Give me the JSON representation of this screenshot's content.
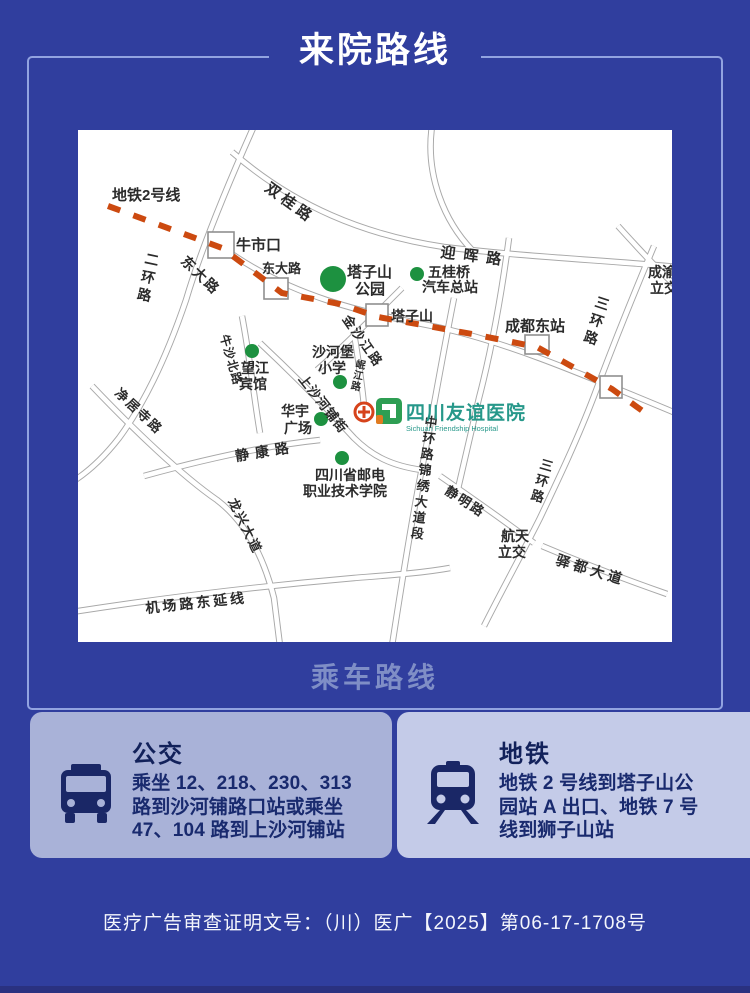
{
  "page": {
    "title": "来院路线",
    "section_label": "乘车路线",
    "footer": "医疗广告审查证明文号：（川）医广【2025】第06-17-1708号"
  },
  "cards": {
    "bus": {
      "title": "公交",
      "lines": [
        "乘坐 12、218、230、313",
        "路到沙河铺路口站或乘坐",
        "47、104 路到上沙河铺站"
      ]
    },
    "metro": {
      "title": "地铁",
      "lines": [
        "地铁 2 号线到塔子山公",
        "园站 A 出口、地铁 7 号",
        "线到狮子山站"
      ]
    }
  },
  "map": {
    "hospital": {
      "name": "四川友谊医院",
      "name_en": "Sichuan Friendship Hospital"
    },
    "metro_line": {
      "label": "地铁2号线",
      "points": [
        [
          30,
          76
        ],
        [
          144,
          118
        ],
        [
          204,
          163
        ],
        [
          262,
          174
        ],
        [
          300,
          187
        ],
        [
          394,
          204
        ],
        [
          459,
          217
        ],
        [
          534,
          259
        ],
        [
          566,
          282
        ]
      ]
    },
    "roads": [
      {
        "name": "erhuan-lu",
        "d": "M 176,-4 C 142,72 121,126 108,170 C 91,220 69,270 41,308 C 23,331 7,344 -6,352"
      },
      {
        "name": "dongda-lu-corridor",
        "d": "M 148,120 C 214,167 284,182 354,196 C 424,210 504,244 600,284"
      },
      {
        "name": "shuanggui-yinghui-lu",
        "d": "M 154,22 C 216,76 286,105 366,117 C 449,127 524,130 600,137"
      },
      {
        "name": "north-road",
        "d": "M 354,-4 C 347,46 367,92 394,120"
      },
      {
        "name": "east-station-road",
        "d": "M 431,108 C 423,168 413,222 401,268 C 393,303 386,333 379,363"
      },
      {
        "name": "sanhuan-lu",
        "d": "M 576,116 C 554,168 534,218 516,266 C 500,308 481,348 462,388 C 444,424 424,460 406,496"
      },
      {
        "name": "zhonghuan-lu",
        "d": "M 376,168 C 364,228 354,288 344,338 C 336,378 326,438 314,516"
      },
      {
        "name": "jinshajiang-lu",
        "d": "M 324,158 C 294,188 264,218 239,240"
      },
      {
        "name": "shangshahepu-jie",
        "d": "M 182,213 C 214,243 244,273 276,308 C 294,326 314,336 344,340"
      },
      {
        "name": "minjiang-lu",
        "d": "M 276,203 C 280,228 284,253 286,276"
      },
      {
        "name": "niusha-bei-lu",
        "d": "M 164,186 C 172,228 176,268 182,303"
      },
      {
        "name": "jingkang-lu",
        "d": "M 66,346 C 124,330 184,316 242,310"
      },
      {
        "name": "jingjusi-longxing",
        "d": "M 14,256 C 54,298 104,346 139,370 C 169,393 186,428 196,468 L 202,516"
      },
      {
        "name": "jichang-lu-east",
        "d": "M -6,482 C 84,468 184,456 276,448 C 314,445 344,443 372,438"
      },
      {
        "name": "jingming-lu",
        "d": "M 362,346 C 394,368 429,393 456,413"
      },
      {
        "name": "yidu-dadao",
        "d": "M 464,416 C 504,433 549,450 589,464"
      },
      {
        "name": "chengyu-crossing",
        "d": "M 540,96 C 560,118 580,140 600,158"
      }
    ],
    "stations": [
      {
        "name": "牛市口",
        "x": 130,
        "y": 102,
        "w": 26,
        "h": 26
      },
      {
        "name": "东大路",
        "x": 186,
        "y": 148,
        "w": 24,
        "h": 21
      },
      {
        "name": "塔子山",
        "x": 288,
        "y": 174,
        "w": 22,
        "h": 22
      },
      {
        "name": "成都东站",
        "x": 447,
        "y": 205,
        "w": 24,
        "h": 19
      },
      {
        "name": "station",
        "x": 522,
        "y": 246,
        "w": 22,
        "h": 22
      }
    ],
    "pois": [
      {
        "name": "塔子山公园",
        "x": 255,
        "y": 149,
        "r": 13
      },
      {
        "name": "五桂桥汽车总站",
        "x": 339,
        "y": 144,
        "r": 7
      },
      {
        "name": "望江宾馆",
        "x": 174,
        "y": 221,
        "r": 7
      },
      {
        "name": "沙河堡小学",
        "x": 262,
        "y": 252,
        "r": 7
      },
      {
        "name": "华宇广场",
        "x": 243,
        "y": 289,
        "r": 7
      },
      {
        "name": "四川省邮电职业技术学院",
        "x": 264,
        "y": 328,
        "r": 7
      }
    ],
    "labels": [
      {
        "t": "地铁2号线",
        "x": 34,
        "y": 70,
        "s": 15
      },
      {
        "t": "双桂路",
        "x": 186,
        "y": 60,
        "s": 15,
        "rot": 36,
        "ls": 4
      },
      {
        "t": "牛市口",
        "x": 158,
        "y": 120,
        "s": 15
      },
      {
        "t": "东大路",
        "x": 102,
        "y": 132,
        "s": 14,
        "rot": 44,
        "ls": 2
      },
      {
        "t": "东大路",
        "x": 184,
        "y": 143,
        "s": 13
      },
      {
        "t": "迎晖路",
        "x": 362,
        "y": 127,
        "s": 15,
        "rot": 7,
        "ls": 8
      },
      {
        "t": "二环路",
        "x": 66,
        "y": 133,
        "s": 14,
        "vert": true,
        "lh": 18,
        "rot": 12
      },
      {
        "t": "塔子山",
        "x": 269,
        "y": 147,
        "s": 15
      },
      {
        "t": "公园",
        "x": 277,
        "y": 164,
        "s": 15
      },
      {
        "t": "五桂桥",
        "x": 350,
        "y": 147,
        "s": 14
      },
      {
        "t": "汽车总站",
        "x": 344,
        "y": 162,
        "s": 14
      },
      {
        "t": "塔子山",
        "x": 313,
        "y": 191,
        "s": 14
      },
      {
        "t": "成都东站",
        "x": 427,
        "y": 201,
        "s": 15
      },
      {
        "t": "成渝",
        "x": 570,
        "y": 147,
        "s": 14
      },
      {
        "t": "立交",
        "x": 572,
        "y": 163,
        "s": 14
      },
      {
        "t": "三环路",
        "x": 516,
        "y": 176,
        "s": 14,
        "vert": true,
        "lh": 18,
        "rot": 18
      },
      {
        "t": "金沙江路",
        "x": 264,
        "y": 189,
        "s": 13,
        "rot": 55,
        "ls": 2
      },
      {
        "t": "沙河堡",
        "x": 234,
        "y": 227,
        "s": 14
      },
      {
        "t": "小学",
        "x": 240,
        "y": 243,
        "s": 14
      },
      {
        "t": "岷江路",
        "x": 277,
        "y": 237,
        "s": 10,
        "vert": true,
        "lh": 11,
        "rot": 12
      },
      {
        "t": "望江",
        "x": 163,
        "y": 243,
        "s": 14
      },
      {
        "t": "宾馆",
        "x": 161,
        "y": 259,
        "s": 14
      },
      {
        "t": "牛沙北路",
        "x": 142,
        "y": 206,
        "s": 12,
        "rot": 74,
        "ls": 1
      },
      {
        "t": "上沙河铺街",
        "x": 220,
        "y": 249,
        "s": 13,
        "rot": 52,
        "ls": 1
      },
      {
        "t": "华宇",
        "x": 203,
        "y": 286,
        "s": 14
      },
      {
        "t": "广场",
        "x": 206,
        "y": 303,
        "s": 14
      },
      {
        "t": "静康路",
        "x": 158,
        "y": 331,
        "s": 14,
        "rot": -9,
        "ls": 6
      },
      {
        "t": "四川省邮电",
        "x": 237,
        "y": 350,
        "s": 14
      },
      {
        "t": "职业技术学院",
        "x": 225,
        "y": 366,
        "s": 14
      },
      {
        "t": "净居寺路",
        "x": 36,
        "y": 264,
        "s": 13,
        "rot": 43,
        "ls": 2
      },
      {
        "t": "龙兴大道",
        "x": 150,
        "y": 371,
        "s": 13,
        "rot": 64,
        "ls": 2
      },
      {
        "t": "中环路锦绣大道段",
        "x": 346,
        "y": 296,
        "s": 13,
        "vert": true,
        "lh": 16,
        "rot": 7
      },
      {
        "t": "静明路",
        "x": 366,
        "y": 363,
        "s": 13,
        "rot": 33,
        "ls": 2
      },
      {
        "t": "三环路",
        "x": 461,
        "y": 338,
        "s": 13,
        "vert": true,
        "lh": 16,
        "rot": 16
      },
      {
        "t": "航天",
        "x": 423,
        "y": 411,
        "s": 14
      },
      {
        "t": "立交",
        "x": 420,
        "y": 427,
        "s": 14
      },
      {
        "t": "驿都大道",
        "x": 477,
        "y": 434,
        "s": 14,
        "rot": 17,
        "ls": 4
      },
      {
        "t": "机场路东延线",
        "x": 68,
        "y": 483,
        "s": 14,
        "rot": -6,
        "ls": 3
      }
    ]
  },
  "colors": {
    "background": "#303e9e",
    "frame_border": "#92a3e0",
    "section_label": "#7f8ec6",
    "card_bus_bg": "#a9b2d8",
    "card_metro_bg": "#c4cbe8",
    "card_icon_navy": "#1a2766",
    "card_text_navy": "#192a6e",
    "metro_dash_red": "#cc4a10",
    "poi_green": "#1d9140",
    "hospital_teal": "#27988a",
    "hospital_cross_red": "#d6431b",
    "road_casing_gray": "#a8a8a8",
    "map_background": "#ffffff",
    "bottom_strip": "#2a3180"
  }
}
